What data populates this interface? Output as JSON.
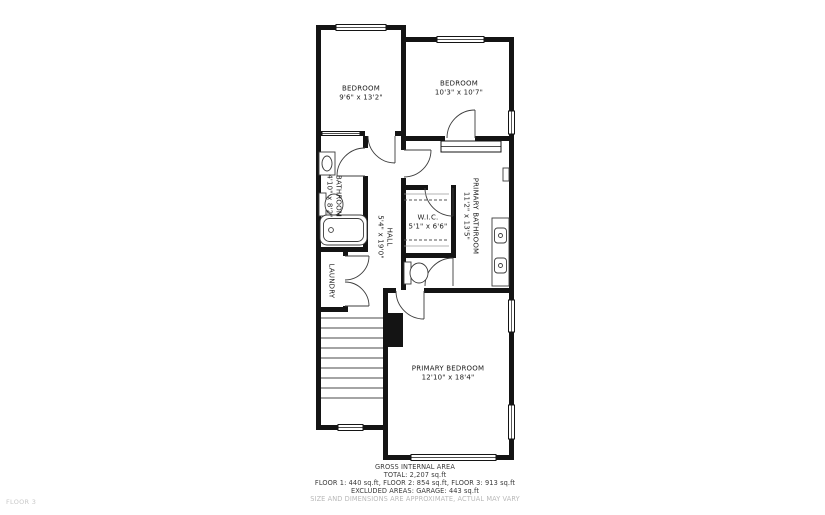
{
  "watermark": "FLOOR 3",
  "rooms": {
    "bedroom_left": {
      "name": "BEDROOM",
      "dims": "9'6\" x 13'2\""
    },
    "bedroom_right": {
      "name": "BEDROOM",
      "dims": "10'3\" x 10'7\""
    },
    "bathroom": {
      "name": "BATHROOM",
      "dims": "4'10\" x 8'2\""
    },
    "hall": {
      "name": "HALL",
      "dims": "5'4\" x 19'0\""
    },
    "wic": {
      "name": "W.I.C.",
      "dims": "5'1\" x 6'6\""
    },
    "primary_bathroom": {
      "name": "PRIMARY BATHROOM",
      "dims": "11'2\" x 13'5\""
    },
    "laundry": {
      "name": "LAUNDRY"
    },
    "primary_bedroom": {
      "name": "PRIMARY BEDROOM",
      "dims": "12'10\" x 18'4\""
    }
  },
  "footer": {
    "title": "GROSS INTERNAL AREA",
    "total": "TOTAL: 2,207 sq.ft",
    "floors": "FLOOR 1: 440 sq.ft, FLOOR 2: 854 sq.ft, FLOOR 3: 913 sq.ft",
    "excluded": "EXCLUDED AREAS: GARAGE: 443 sq.ft",
    "disclaimer": "SIZE AND DIMENSIONS ARE APPROXIMATE, ACTUAL MAY VARY"
  },
  "colors": {
    "wall": "#141414",
    "line": "#3c3c3c",
    "text": "#1b1b1b",
    "muted": "#b9b9b9",
    "watermark": "#c9c9c9"
  }
}
